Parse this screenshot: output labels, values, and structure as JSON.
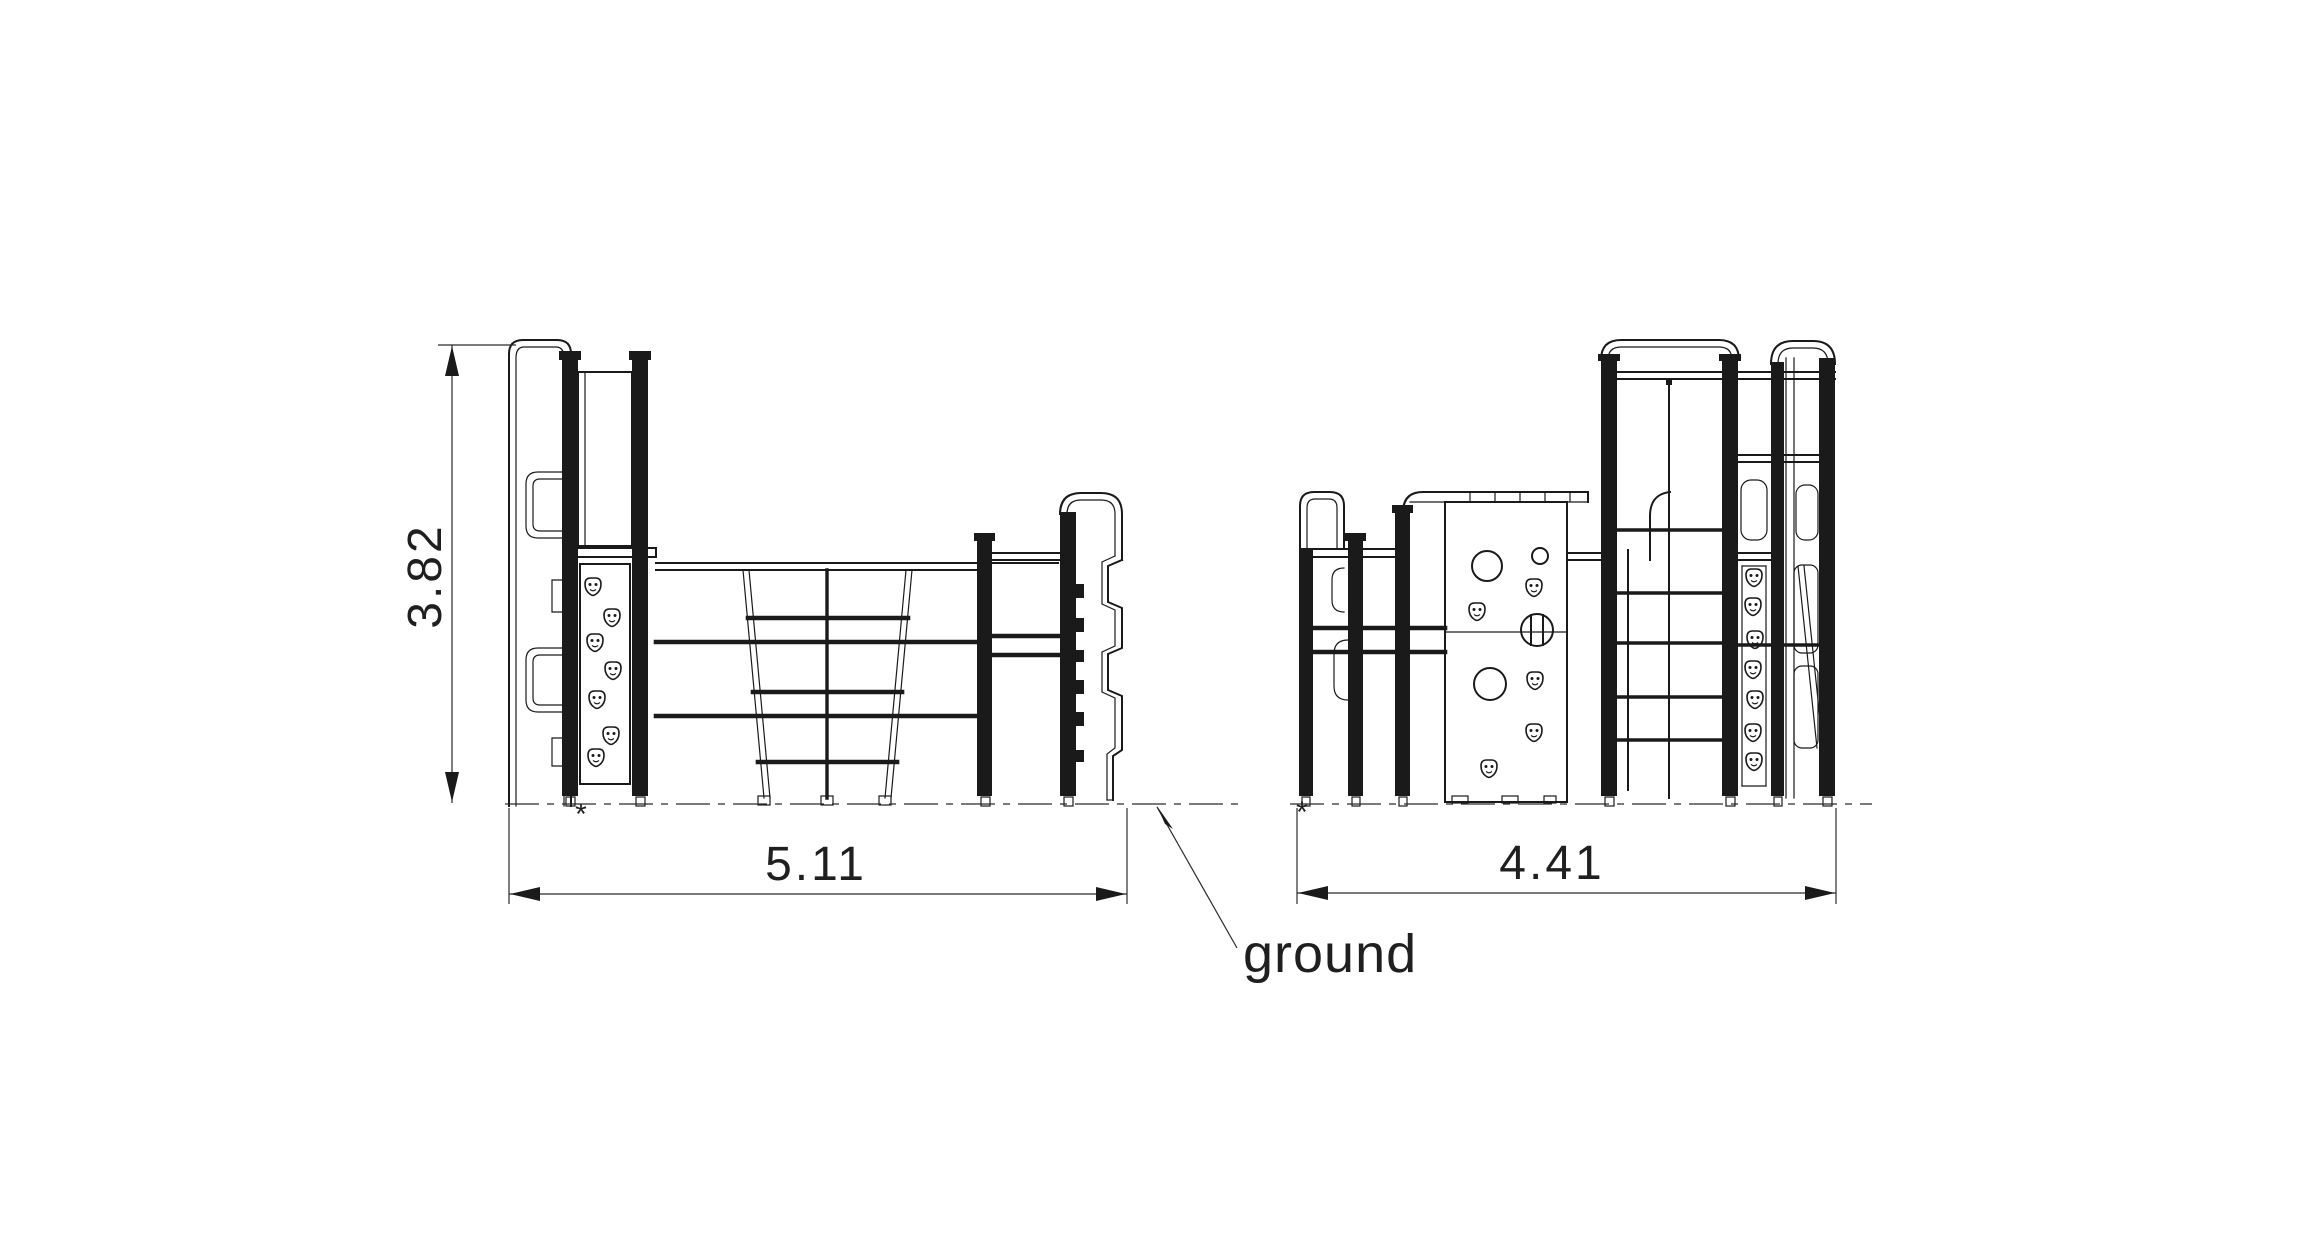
{
  "drawing": {
    "background_color": "#ffffff",
    "line_color": "#1a1a1a",
    "ground_label": "ground",
    "datum_mark": "*",
    "views": [
      {
        "id": "side-elevation",
        "width_dim": "5.11",
        "height_dim": "3.82"
      },
      {
        "id": "end-elevation",
        "width_dim": "4.41"
      }
    ]
  }
}
